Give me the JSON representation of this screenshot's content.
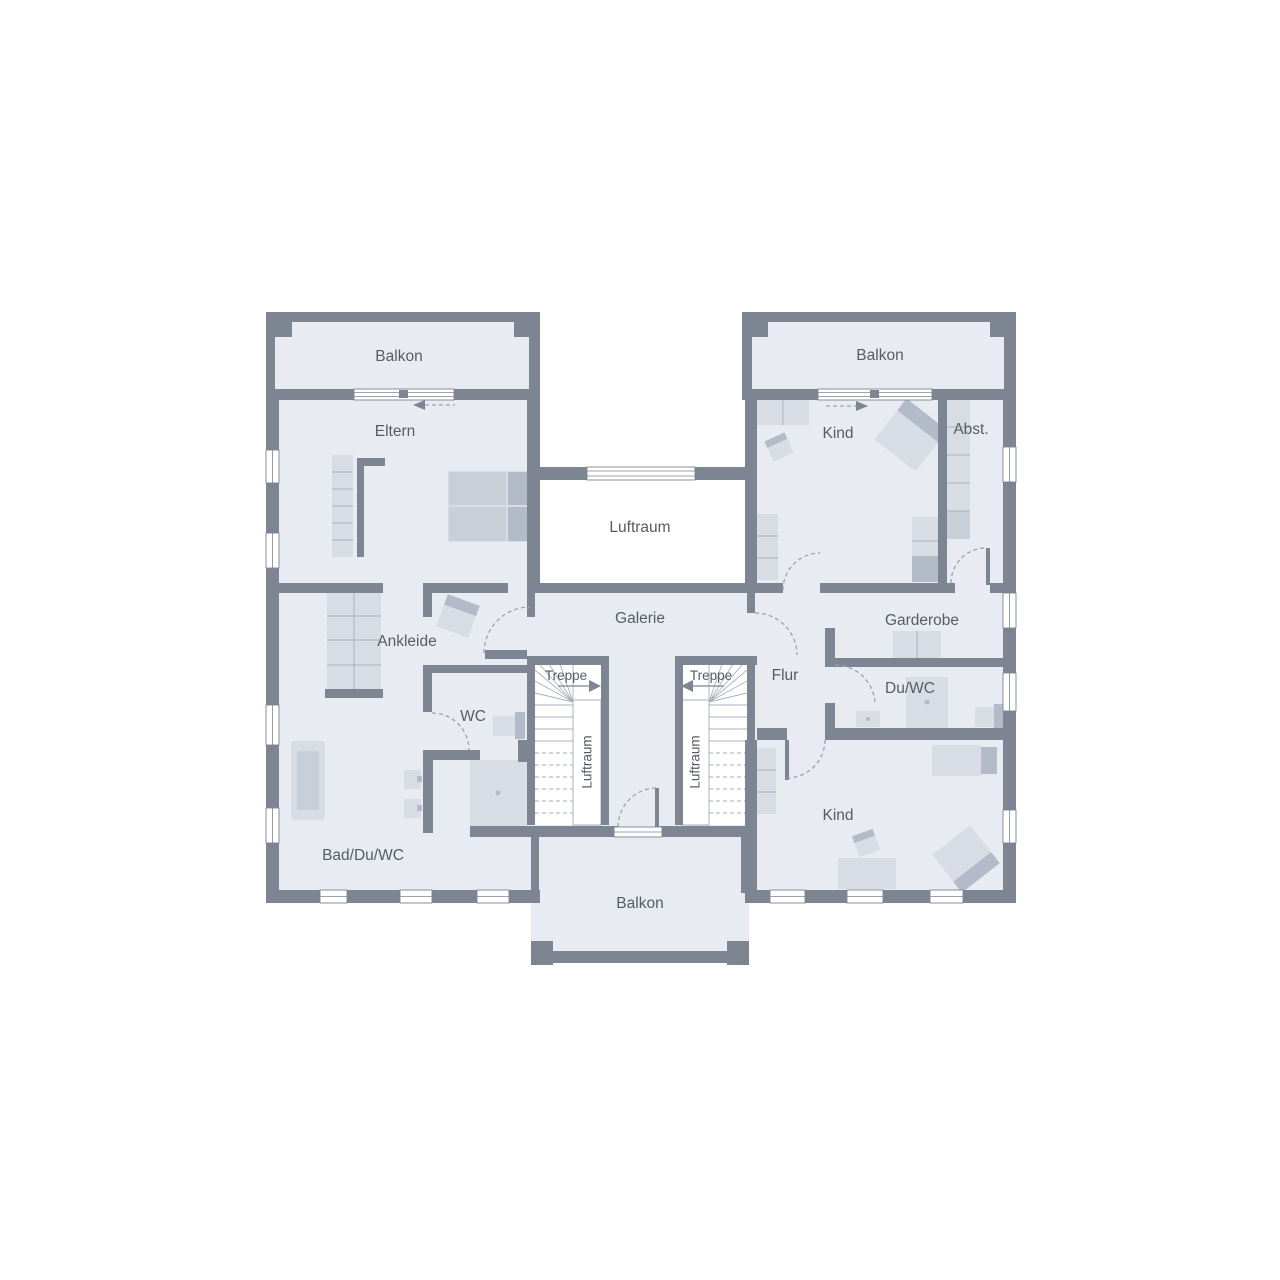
{
  "plan": {
    "labels": {
      "balkon_top_left": "Balkon",
      "balkon_top_right": "Balkon",
      "balkon_bottom": "Balkon",
      "eltern": "Eltern",
      "kind_top": "Kind",
      "kind_bottom": "Kind",
      "abst": "Abst.",
      "luftraum_center": "Luftraum",
      "luftraum_stair_left": "Luftraum",
      "luftraum_stair_right": "Luftraum",
      "galerie": "Galerie",
      "garderobe": "Garderobe",
      "ankleide": "Ankleide",
      "treppe_left": "Treppe",
      "treppe_right": "Treppe",
      "flur": "Flur",
      "wc": "WC",
      "du_wc": "Du/WC",
      "bad_du_wc": "Bad/Du/WC"
    },
    "colors": {
      "wall": "#7d8593",
      "floor": "#e8ebf1",
      "void": "#ffffff",
      "furniture": "#d8dce4",
      "furniture_mid": "#c9cfd9",
      "furniture_dark": "#b4bbc8",
      "outline": "#aab1bd",
      "door": "#9aa2ae",
      "text": "#565c66"
    }
  }
}
